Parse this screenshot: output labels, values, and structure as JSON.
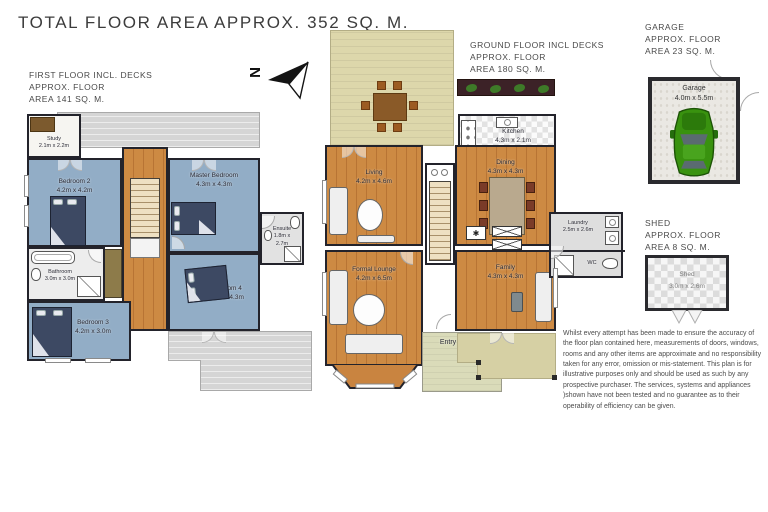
{
  "title": "TOTAL FLOOR AREA  APPROX.  352 SQ. M.",
  "compass": {
    "letter": "N"
  },
  "symbols": {
    "fireplace": "✱"
  },
  "first_floor": {
    "label": [
      "FIRST FLOOR INCL. DECKS",
      "APPROX. FLOOR",
      "AREA 141 SQ. M."
    ],
    "rooms": [
      {
        "name": "Study",
        "dims": "2.1m x 2.2m"
      },
      {
        "name": "Bedroom 2",
        "dims": "4.2m x 4.2m"
      },
      {
        "name": "Master Bedroom",
        "dims": "4.3m x 4.3m"
      },
      {
        "name": "Ensuite",
        "dims": "1.8m x 2.7m"
      },
      {
        "name": "Bathroom",
        "dims": "3.0m x 3.0m"
      },
      {
        "name": "Bedroom 3",
        "dims": "4.2m x 3.0m"
      },
      {
        "name": "Bedroom 4",
        "dims": "3.6m x 4.3m"
      }
    ]
  },
  "ground_floor": {
    "label": [
      "GROUND FLOOR INCL DECKS",
      "APPROX. FLOOR",
      "AREA 180 SQ. M."
    ],
    "rooms": [
      {
        "name": "Living",
        "dims": "4.2m x 4.6m"
      },
      {
        "name": "Kitchen",
        "dims": "4.3m x 2.1m"
      },
      {
        "name": "Dining",
        "dims": "4.3m x 4.3m"
      },
      {
        "name": "Formal Lounge",
        "dims": "4.2m x 6.5m"
      },
      {
        "name": "Family",
        "dims": "4.3m x 4.3m"
      },
      {
        "name": "Laundry",
        "dims": "2.5m x 2.6m"
      },
      {
        "name": "WC",
        "dims": ""
      },
      {
        "name": "Entry",
        "dims": ""
      }
    ]
  },
  "garage": {
    "label": [
      "GARAGE",
      "APPROX. FLOOR",
      "AREA 23 SQ. M."
    ],
    "room_name": "Garage",
    "room_dims": "4.0m x 5.5m"
  },
  "shed": {
    "label": [
      "SHED",
      "APPROX. FLOOR",
      "AREA 8 SQ. M."
    ],
    "room_name": "Shed",
    "room_dims": "3.0m x 2.6m"
  },
  "disclaimer": "Whilst every attempt has been made to ensure the accuracy of the floor plan contained here, measurements of doors, windows, rooms and any other items are approximate and no responsibility taken for any error, omission or mis-statement. This plan is for illustrative purposes only and should be used as such by any prospective purchaser. The services, systems and appliances )shown have not been tested and no guarantee as to their operability of efficiency can be given.",
  "colors": {
    "bedroom_blue": "#92adc6",
    "bed_navy": "#3d4963",
    "wood_floor": "#cd8a43",
    "deck_gray": "#d5d5d5",
    "deck_tan": "#ddd7ab",
    "wall": "#23232b",
    "car_green": "#39920f",
    "garden_bed": "#3c2227"
  }
}
